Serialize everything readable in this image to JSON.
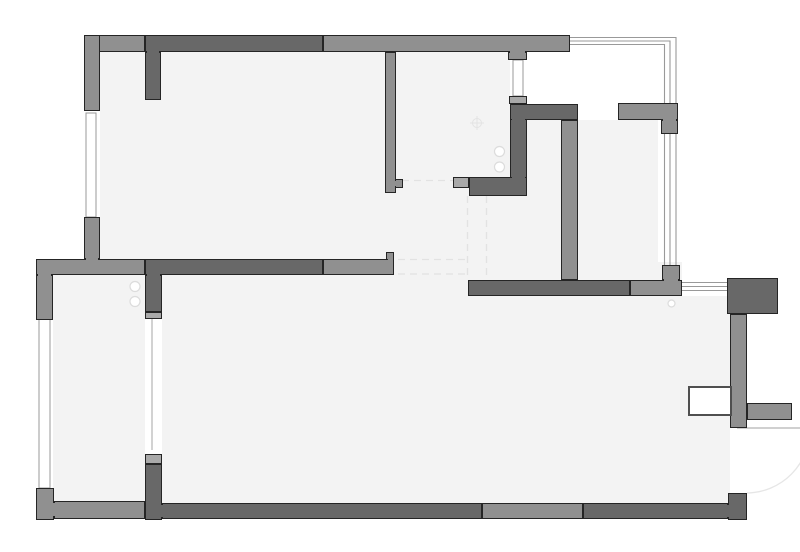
{
  "title": "apartment-floor-plan",
  "colors": {
    "background": "#ffffff",
    "floor": "#f3f3f3",
    "outline": "#252525",
    "tones": {
      "dark": "#686868",
      "medium": "#909090",
      "light": "#a9a9a9"
    },
    "window_line": "#999999",
    "thin_line": "#b3b3b3",
    "dashed_line": "#e2e2e2",
    "arc_line": "#e6e6e6",
    "fixture_stroke": "#dcdcdc",
    "target_stroke": "#e3e3e3",
    "door_border": "#4f4f4f"
  },
  "floors": [
    {
      "name": "floor-top-left-room",
      "x": 100,
      "y": 51,
      "w": 295,
      "h": 210
    },
    {
      "name": "floor-left-lower-room",
      "x": 53,
      "y": 261,
      "w": 92,
      "h": 245
    },
    {
      "name": "floor-center-passage",
      "x": 385,
      "y": 51,
      "w": 125,
      "h": 230
    },
    {
      "name": "floor-hallway",
      "x": 460,
      "y": 104,
      "w": 118,
      "h": 192
    },
    {
      "name": "floor-right-upper-room",
      "x": 578,
      "y": 120,
      "w": 80,
      "h": 176
    },
    {
      "name": "floor-right-room-lower-strip",
      "x": 578,
      "y": 262,
      "w": 104,
      "h": 34
    },
    {
      "name": "floor-main-lower-room",
      "x": 162,
      "y": 275,
      "w": 520,
      "h": 230
    },
    {
      "name": "floor-lower-right-strip",
      "x": 682,
      "y": 296,
      "w": 48,
      "h": 209
    }
  ],
  "walls": [
    {
      "name": "wall-top-left-block",
      "x": 84,
      "y": 35,
      "w": 61,
      "h": 17,
      "tone": "medium"
    },
    {
      "name": "wall-top-dark",
      "x": 145,
      "y": 35,
      "w": 178,
      "h": 17,
      "tone": "dark"
    },
    {
      "name": "wall-top-right",
      "x": 323,
      "y": 35,
      "w": 247,
      "h": 17,
      "tone": "medium"
    },
    {
      "name": "wall-left-upper",
      "x": 84,
      "y": 35,
      "w": 16,
      "h": 76,
      "tone": "medium"
    },
    {
      "name": "wall-left-mid",
      "x": 84,
      "y": 217,
      "w": 16,
      "h": 42,
      "tone": "medium"
    },
    {
      "name": "wall-west-horizontal",
      "x": 36,
      "y": 259,
      "w": 109,
      "h": 16,
      "tone": "medium"
    },
    {
      "name": "wall-left-lower",
      "x": 36,
      "y": 275,
      "w": 17,
      "h": 45,
      "tone": "medium"
    },
    {
      "name": "wall-bottom-left-corner",
      "x": 36,
      "y": 488,
      "w": 18,
      "h": 32,
      "tone": "medium"
    },
    {
      "name": "wall-bottom-left",
      "x": 54,
      "y": 501,
      "w": 91,
      "h": 18,
      "tone": "medium"
    },
    {
      "name": "wall-divider-cap-lower",
      "x": 145,
      "y": 454,
      "w": 17,
      "h": 10,
      "tone": "light"
    },
    {
      "name": "wall-divider-lower",
      "x": 145,
      "y": 464,
      "w": 17,
      "h": 56,
      "tone": "dark"
    },
    {
      "name": "wall-bottom-mid-dark",
      "x": 162,
      "y": 503,
      "w": 320,
      "h": 16,
      "tone": "dark"
    },
    {
      "name": "wall-bottom-mid-light",
      "x": 482,
      "y": 503,
      "w": 101,
      "h": 16,
      "tone": "medium"
    },
    {
      "name": "wall-bottom-right",
      "x": 583,
      "y": 503,
      "w": 145,
      "h": 16,
      "tone": "dark"
    },
    {
      "name": "wall-bottom-right-corner",
      "x": 728,
      "y": 493,
      "w": 19,
      "h": 27,
      "tone": "dark"
    },
    {
      "name": "wall-divider-upper",
      "x": 145,
      "y": 275,
      "w": 17,
      "h": 37,
      "tone": "dark"
    },
    {
      "name": "wall-divider-cap-upper",
      "x": 145,
      "y": 312,
      "w": 17,
      "h": 7,
      "tone": "light"
    },
    {
      "name": "wall-top-stub",
      "x": 145,
      "y": 52,
      "w": 16,
      "h": 48,
      "tone": "dark"
    },
    {
      "name": "wall-center-vertical",
      "x": 385,
      "y": 52,
      "w": 11,
      "h": 141,
      "tone": "medium"
    },
    {
      "name": "wall-center-foot",
      "x": 395,
      "y": 179,
      "w": 8,
      "h": 9,
      "tone": "medium"
    },
    {
      "name": "wall-mid-notch",
      "x": 386,
      "y": 252,
      "w": 8,
      "h": 8,
      "tone": "medium"
    },
    {
      "name": "wall-interior-dark",
      "x": 145,
      "y": 259,
      "w": 178,
      "h": 16,
      "tone": "dark"
    },
    {
      "name": "wall-interior-light",
      "x": 323,
      "y": 259,
      "w": 71,
      "h": 16,
      "tone": "medium"
    },
    {
      "name": "wall-window-stub-top",
      "x": 508,
      "y": 52,
      "w": 19,
      "h": 8,
      "tone": "medium"
    },
    {
      "name": "wall-cap-above-kitchen",
      "x": 509,
      "y": 96,
      "w": 18,
      "h": 8,
      "tone": "light"
    },
    {
      "name": "wall-kitchen-vertical",
      "x": 510,
      "y": 104,
      "w": 17,
      "h": 92,
      "tone": "dark"
    },
    {
      "name": "wall-kitchen-top",
      "x": 510,
      "y": 104,
      "w": 68,
      "h": 16,
      "tone": "dark"
    },
    {
      "name": "wall-kitchen-bottom",
      "x": 469,
      "y": 177,
      "w": 58,
      "h": 19,
      "tone": "dark"
    },
    {
      "name": "wall-cap-left-stub",
      "x": 453,
      "y": 177,
      "w": 16,
      "h": 11,
      "tone": "light"
    },
    {
      "name": "wall-inner-vertical",
      "x": 561,
      "y": 120,
      "w": 17,
      "h": 160,
      "tone": "medium"
    },
    {
      "name": "wall-hall-dark",
      "x": 468,
      "y": 280,
      "w": 162,
      "h": 16,
      "tone": "dark"
    },
    {
      "name": "wall-hall-light",
      "x": 630,
      "y": 280,
      "w": 52,
      "h": 16,
      "tone": "medium"
    },
    {
      "name": "wall-hall-stub",
      "x": 662,
      "y": 265,
      "w": 18,
      "h": 15,
      "tone": "medium"
    },
    {
      "name": "wall-balcony-horizontal",
      "x": 618,
      "y": 103,
      "w": 60,
      "h": 17,
      "tone": "medium"
    },
    {
      "name": "wall-balcony-stub",
      "x": 661,
      "y": 120,
      "w": 17,
      "h": 14,
      "tone": "medium"
    },
    {
      "name": "wall-entry-block",
      "x": 727,
      "y": 278,
      "w": 51,
      "h": 36,
      "tone": "dark"
    },
    {
      "name": "wall-right-vertical",
      "x": 730,
      "y": 314,
      "w": 17,
      "h": 114,
      "tone": "medium"
    },
    {
      "name": "wall-entry-stub",
      "x": 747,
      "y": 403,
      "w": 45,
      "h": 17,
      "tone": "medium"
    }
  ],
  "joints": [
    {
      "name": "joint-kitchen-corner",
      "x": 512,
      "y": 114,
      "w": 13,
      "h": 8,
      "tone": "dark"
    },
    {
      "name": "joint-kitchen-bottom",
      "x": 512,
      "y": 174,
      "w": 13,
      "h": 6,
      "tone": "dark"
    },
    {
      "name": "joint-divider-upper",
      "x": 147,
      "y": 272,
      "w": 13,
      "h": 6,
      "tone": "dark"
    },
    {
      "name": "joint-top-stub",
      "x": 147,
      "y": 49,
      "w": 12,
      "h": 6,
      "tone": "dark"
    },
    {
      "name": "joint-window-stub",
      "x": 510,
      "y": 49,
      "w": 15,
      "h": 5,
      "tone": "medium"
    },
    {
      "name": "joint-left-mid",
      "x": 86,
      "y": 256,
      "w": 12,
      "h": 6,
      "tone": "medium"
    },
    {
      "name": "joint-left-lower",
      "x": 38,
      "y": 272,
      "w": 13,
      "h": 6,
      "tone": "medium"
    },
    {
      "name": "joint-bottom-left-corner",
      "x": 52,
      "y": 503,
      "w": 5,
      "h": 13,
      "tone": "medium"
    },
    {
      "name": "joint-bottom-right-corner",
      "x": 725,
      "y": 505,
      "w": 6,
      "h": 12,
      "tone": "dark"
    },
    {
      "name": "joint-divider-bottom",
      "x": 159,
      "y": 505,
      "w": 6,
      "h": 12,
      "tone": "dark"
    },
    {
      "name": "joint-hall-stub",
      "x": 664,
      "y": 277,
      "w": 14,
      "h": 6,
      "tone": "medium"
    },
    {
      "name": "joint-balcony-stub",
      "x": 663,
      "y": 117,
      "w": 13,
      "h": 5,
      "tone": "medium"
    },
    {
      "name": "joint-center-foot",
      "x": 393,
      "y": 181,
      "w": 4,
      "h": 5,
      "tone": "medium"
    },
    {
      "name": "joint-mid-notch",
      "x": 388,
      "y": 257,
      "w": 5,
      "h": 5,
      "tone": "medium"
    }
  ],
  "windows": {
    "boxes": [
      {
        "name": "window-left-upper",
        "x": 86,
        "y": 113,
        "w": 10,
        "h": 104
      },
      {
        "name": "window-left-lower",
        "x": 39,
        "y": 319,
        "w": 11,
        "h": 169
      },
      {
        "name": "window-top-center",
        "x": 513,
        "y": 60,
        "w": 10,
        "h": 36
      }
    ],
    "polylines": [
      {
        "name": "window-bay-outer",
        "points": "570,37.5 676,37.5 676,265"
      },
      {
        "name": "window-bay-middle",
        "points": "570,41 670,41 670,265"
      },
      {
        "name": "window-bay-inner",
        "points": "570,44.5 664.5,44.5 664.5,265"
      },
      {
        "name": "window-right-line-1",
        "points": "682,282.5 727,282.5"
      },
      {
        "name": "window-right-line-2",
        "points": "682,286.5 727,286.5"
      },
      {
        "name": "window-right-line-3",
        "points": "682,290.5 727,290.5"
      }
    ]
  },
  "thin_lines": [
    {
      "name": "opening-line-left",
      "x1": 152,
      "y1": 319,
      "x2": 152,
      "y2": 450
    },
    {
      "name": "door-leaf-line",
      "x1": 737,
      "y1": 428,
      "x2": 800,
      "y2": 428
    }
  ],
  "dashed_lines": [
    {
      "name": "dashed-passage-top",
      "x1": 398,
      "y1": 259.5,
      "x2": 467,
      "y2": 259.5
    },
    {
      "name": "dashed-passage-bottom",
      "x1": 398,
      "y1": 274,
      "x2": 467,
      "y2": 274
    },
    {
      "name": "dashed-hall-left",
      "x1": 467.5,
      "y1": 196,
      "x2": 467.5,
      "y2": 280
    },
    {
      "name": "dashed-hall-right",
      "x1": 486.5,
      "y1": 196,
      "x2": 486.5,
      "y2": 280
    },
    {
      "name": "dashed-passage-upper",
      "x1": 402,
      "y1": 180.5,
      "x2": 453,
      "y2": 180.5
    }
  ],
  "door_swing_arc": {
    "name": "door-swing-arc",
    "d": "M 810,429 A 64,64 0 0 1 747,493"
  },
  "door_panel": {
    "name": "door-panel",
    "x": 688,
    "y": 386,
    "w": 44,
    "h": 30
  },
  "fixtures": [
    {
      "name": "fixture-dot-1",
      "cx": 499.5,
      "cy": 151.5,
      "r": 5
    },
    {
      "name": "fixture-dot-2",
      "cx": 499.5,
      "cy": 167,
      "r": 5
    },
    {
      "name": "fixture-dot-3",
      "cx": 135,
      "cy": 286.5,
      "r": 5
    },
    {
      "name": "fixture-dot-4",
      "cx": 135,
      "cy": 301.5,
      "r": 5
    },
    {
      "name": "fixture-dot-small",
      "cx": 671.5,
      "cy": 303.5,
      "r": 3.5
    }
  ],
  "target_marker": {
    "name": "target-marker",
    "cx": 477,
    "cy": 123,
    "r": 4.5,
    "arm": 7
  }
}
